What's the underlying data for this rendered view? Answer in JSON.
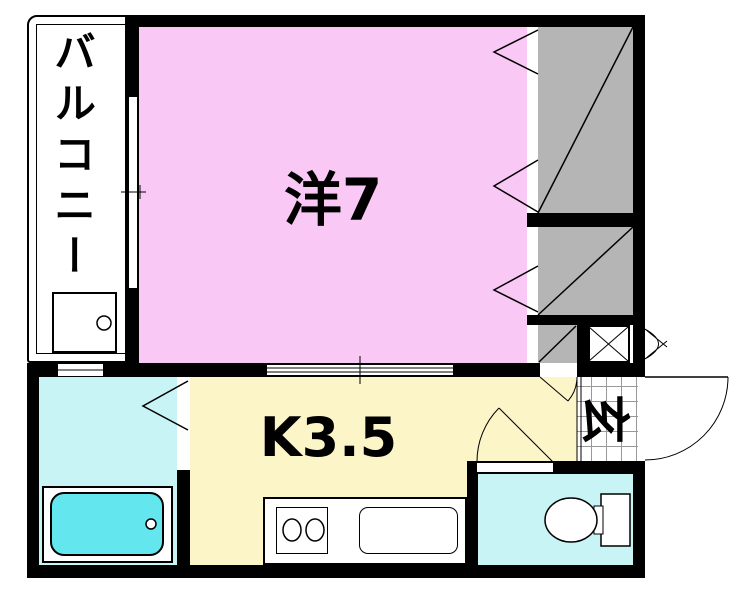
{
  "plan": {
    "title": "1K apartment floor plan",
    "rooms": {
      "balcony": {
        "label": "バルコニー"
      },
      "western_room": {
        "label": "洋7"
      },
      "kitchen": {
        "label": "K3.5"
      },
      "entrance": {
        "label": "玄"
      }
    },
    "colors": {
      "wall": "#000000",
      "background": "#FFFFFF",
      "western_room": "#F9C8F4",
      "kitchen": "#FBF5C8",
      "wet_rooms": "#C9F4F6",
      "bathtub": "#63E6EE",
      "closet": "#B5B5B5",
      "tile_line": "#999999"
    },
    "fixtures": [
      "washing-machine-pan",
      "bathtub",
      "two-burner-stove",
      "kitchen-sink",
      "toilet",
      "shoe-cabinet",
      "closet-upper",
      "closet-lower",
      "kitchen-storage"
    ]
  }
}
